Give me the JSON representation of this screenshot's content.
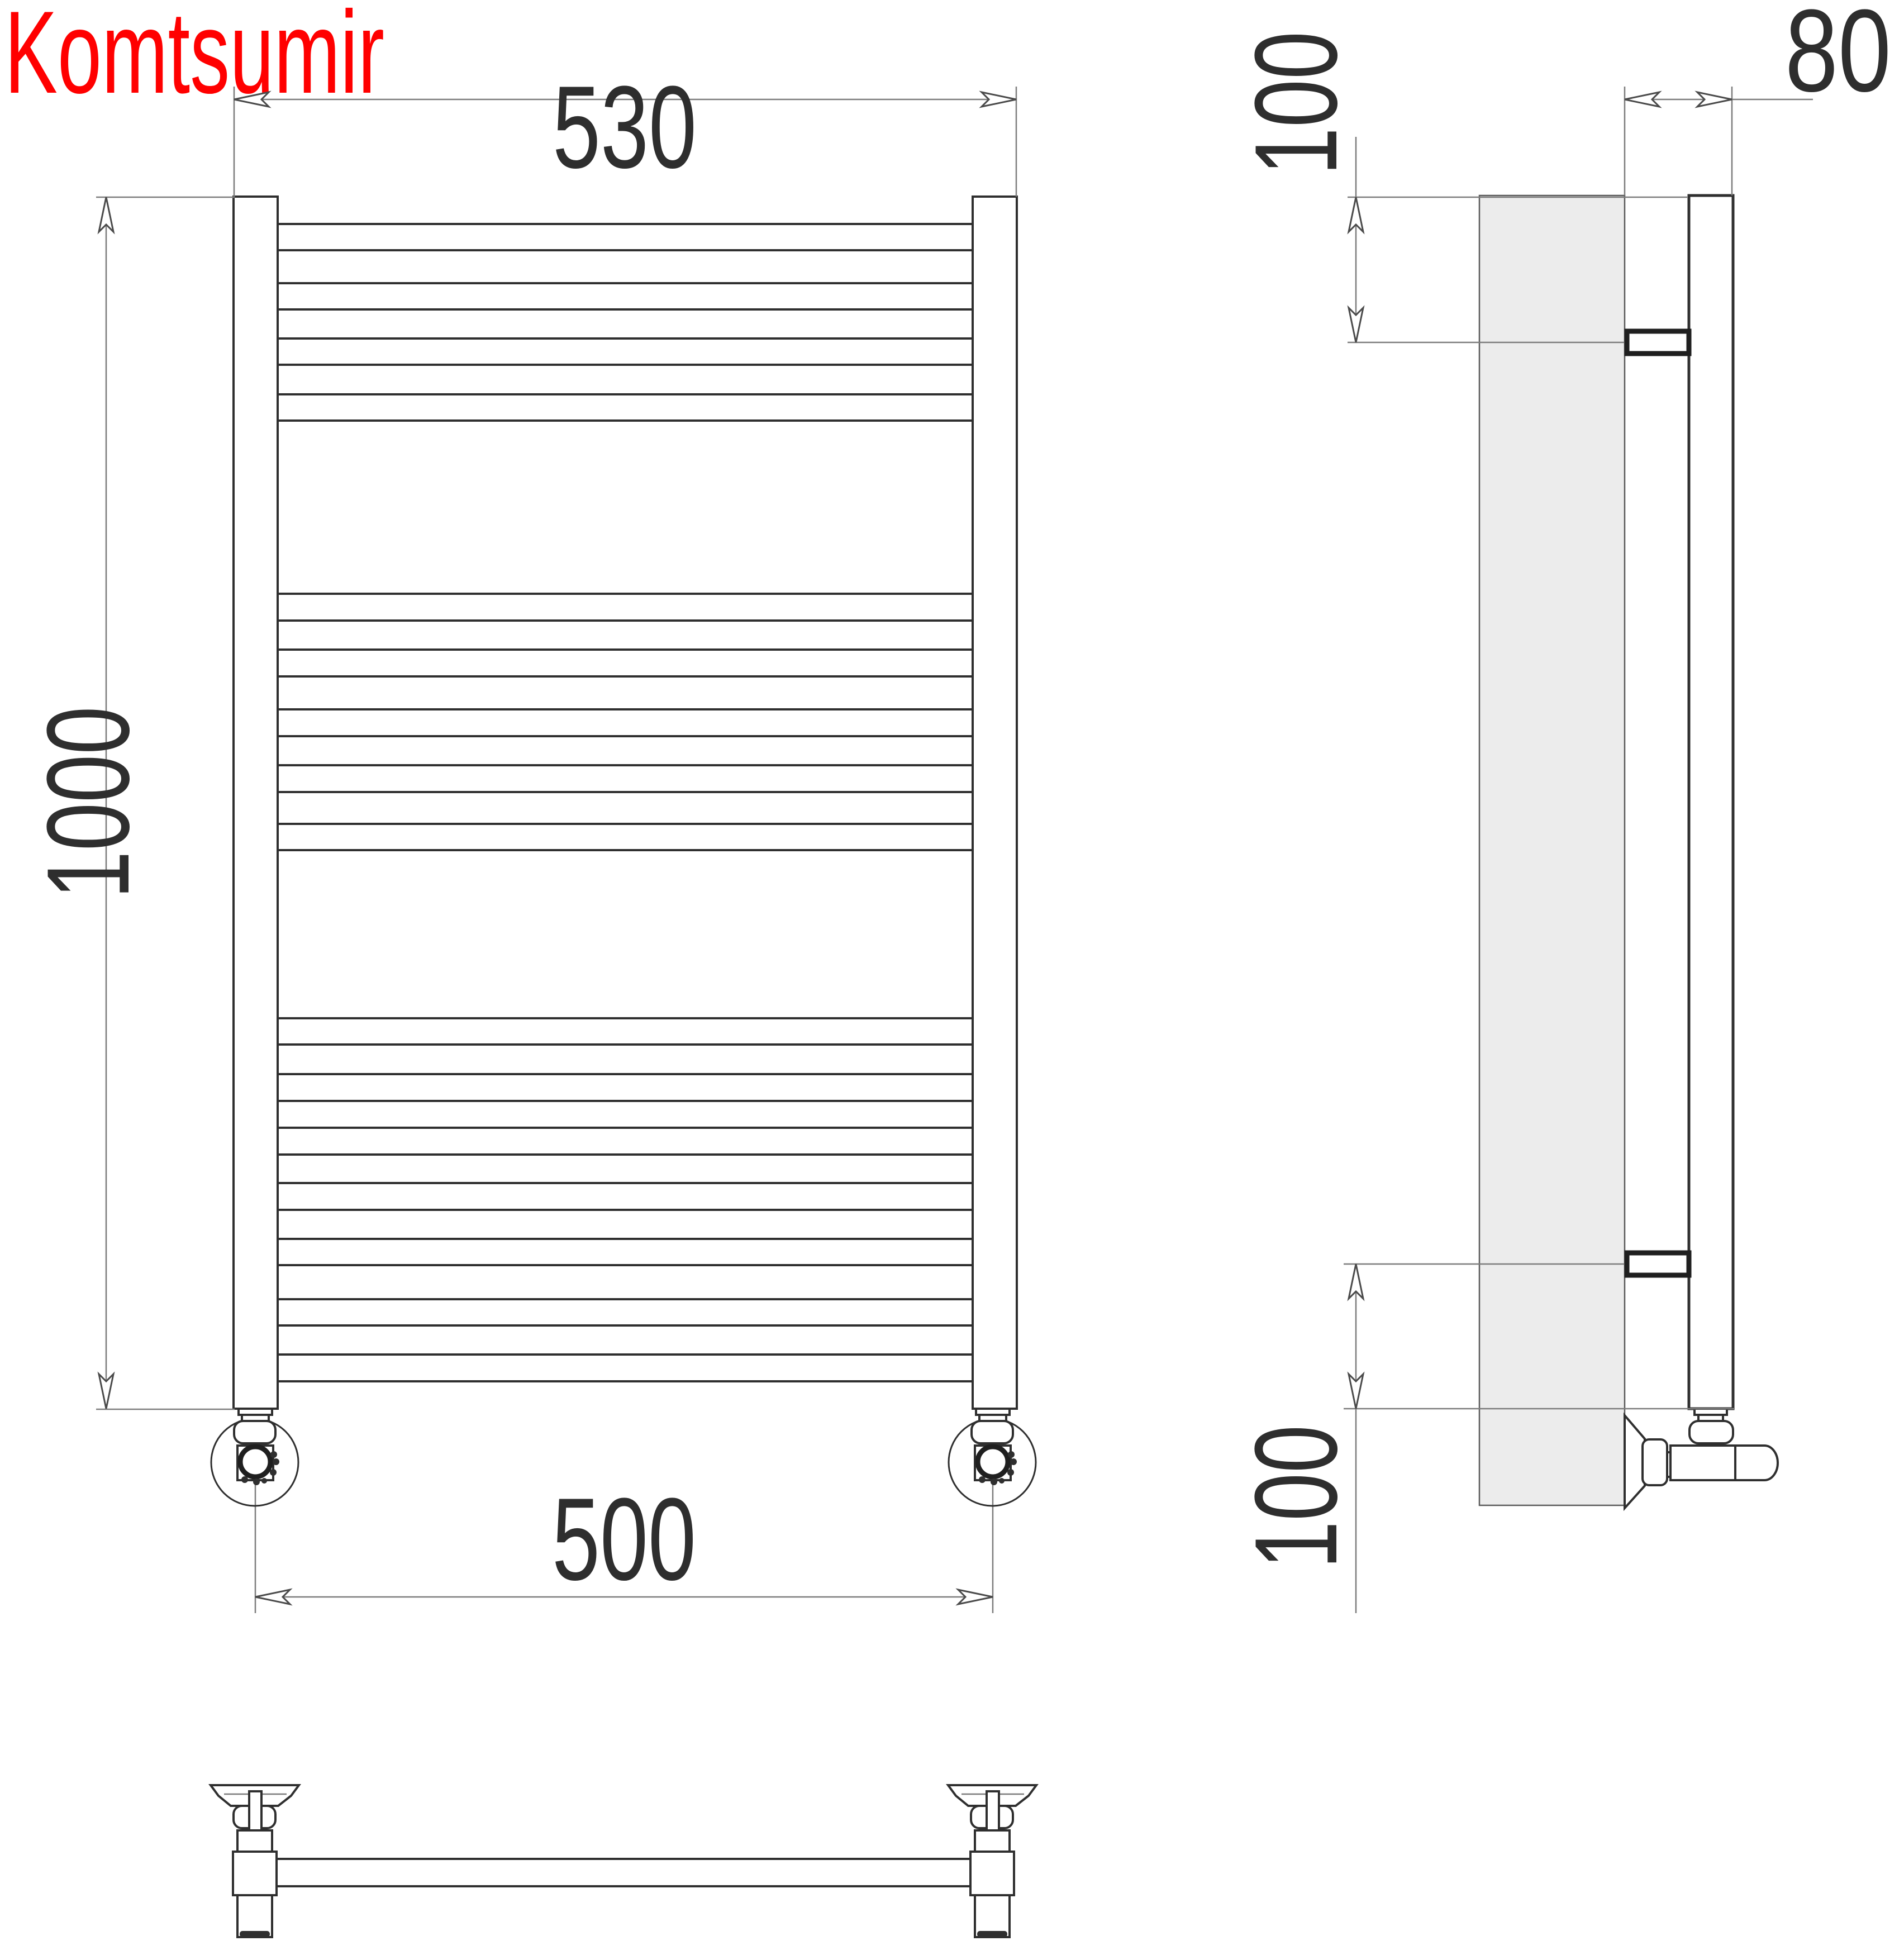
{
  "brand": {
    "name": "Komtsumir",
    "color": "#ff0000"
  },
  "dimensions": {
    "overall_width": "530",
    "overall_height": "1000",
    "connection_spacing": "500",
    "wall_offset": "80",
    "top_bracket_offset": "100",
    "bottom_bracket_offset": "100"
  },
  "drawing": {
    "type": "technical-drawing",
    "subject": "ladder towel rail radiator",
    "views": [
      "front",
      "side",
      "bottom"
    ],
    "rung_groups": [
      4,
      5,
      7
    ],
    "line_color": "#2f2f2f",
    "thin_line_color": "#7d7d7d",
    "wall_fill": "#ececec",
    "text_color": "#2e2e2e",
    "background": "#ffffff"
  }
}
